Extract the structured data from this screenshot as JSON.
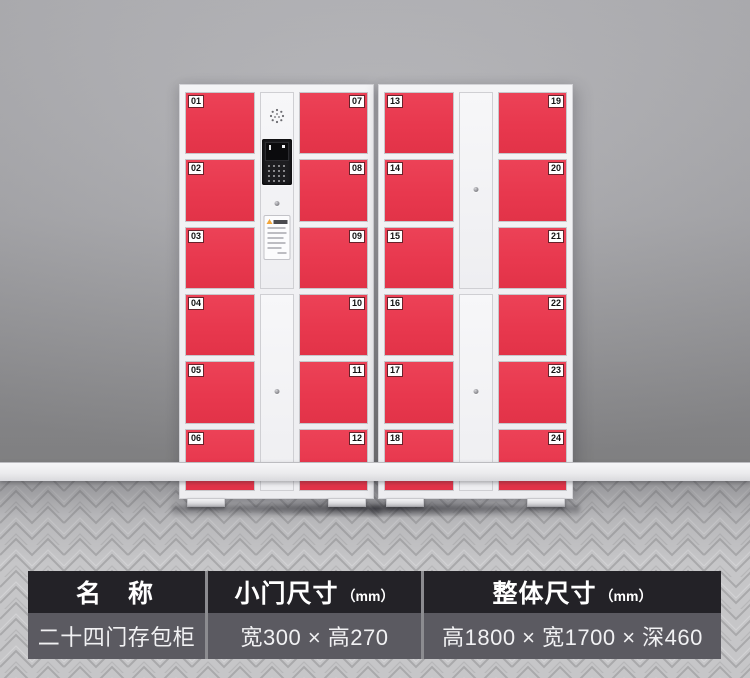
{
  "colors": {
    "door_red": "#E8384E",
    "cabinet_white": "#F4F4F6",
    "wall_gray": "#A9A9AD",
    "floor_gray": "#C6C6C8",
    "table_header_bg": "#1E1D22",
    "table_row_bg": "#58575D"
  },
  "icons": {
    "speaker": "speaker-grill-icon",
    "camera_screen": "camera-screen-icon",
    "keypad": "keypad-dots-icon",
    "lock": "keyhole-lock-icon",
    "warning": "warning-triangle-icon"
  },
  "doors": {
    "c1": [
      "01",
      "02",
      "03",
      "04",
      "05",
      "06"
    ],
    "c2": [
      "07",
      "08",
      "09",
      "10",
      "11",
      "12"
    ],
    "c3": [
      "13",
      "14",
      "15",
      "16",
      "17",
      "18"
    ],
    "c4": [
      "19",
      "20",
      "21",
      "22",
      "23",
      "24"
    ]
  },
  "spec_table": {
    "columns": [
      {
        "header": "名　称",
        "unit": "",
        "value": "二十四门存包柜"
      },
      {
        "header": "小门尺寸",
        "unit": "（mm）",
        "value": "宽300 × 高270"
      },
      {
        "header": "整体尺寸",
        "unit": "（mm）",
        "value": "高1800 × 宽1700 × 深460"
      }
    ]
  }
}
